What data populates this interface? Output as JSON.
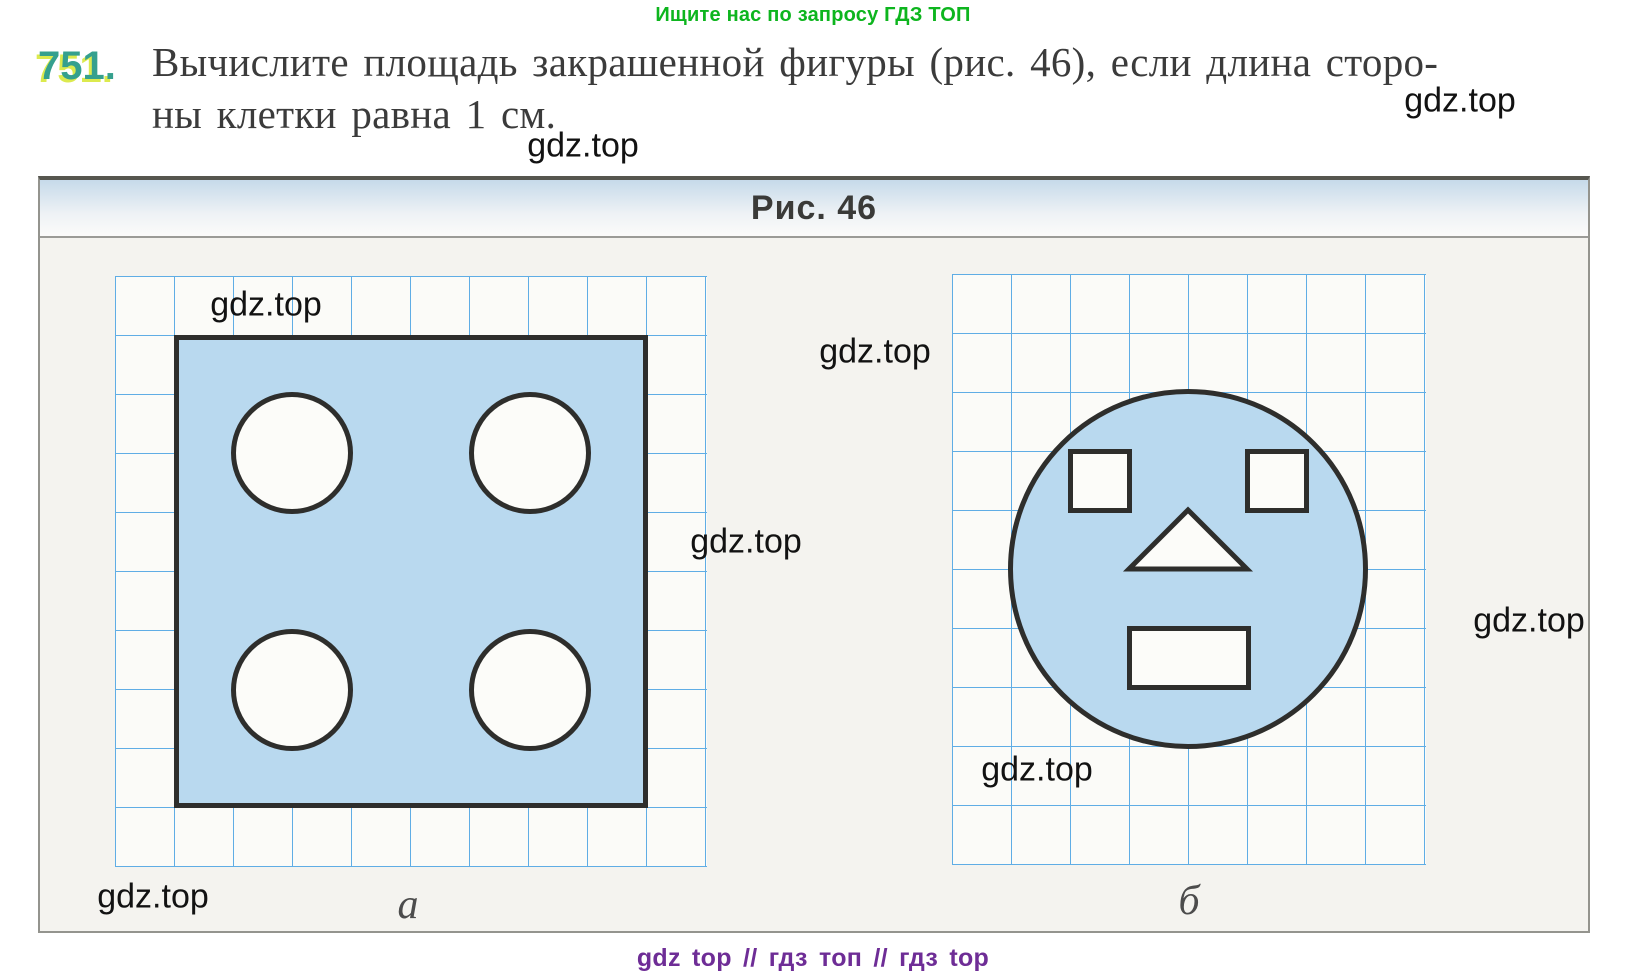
{
  "page": {
    "promo_top": "Ищите нас по запросу ГДЗ ТОП",
    "footer": "gdz top  //  гдз топ  //  гдз top"
  },
  "problem": {
    "number": "751.",
    "text_line1": "Вычислите площадь закрашенной фигуры (рис. 46), если длина сторо-",
    "text_line2": "ны клетки равна 1 см."
  },
  "figure": {
    "caption": "Рис. 46",
    "label_a": "а",
    "label_b": "б"
  },
  "watermarks": [
    {
      "text": "gdz.top",
      "x": 1460,
      "y": 101
    },
    {
      "text": "gdz.top",
      "x": 583,
      "y": 146
    },
    {
      "text": "gdz.top",
      "x": 266,
      "y": 305
    },
    {
      "text": "gdz.top",
      "x": 875,
      "y": 352
    },
    {
      "text": "gdz.top",
      "x": 746,
      "y": 542
    },
    {
      "text": "gdz.top",
      "x": 1529,
      "y": 621
    },
    {
      "text": "gdz.top",
      "x": 1037,
      "y": 770
    },
    {
      "text": "gdz.top",
      "x": 153,
      "y": 897
    }
  ],
  "colors": {
    "green": "#0db51e",
    "teal": "#35a08e",
    "tealGlow": "#dcea4e",
    "gridline": "#5fade5",
    "fill": "#b9d9ef",
    "outline": "#2e2e2c",
    "purple": "#6e2d96"
  }
}
